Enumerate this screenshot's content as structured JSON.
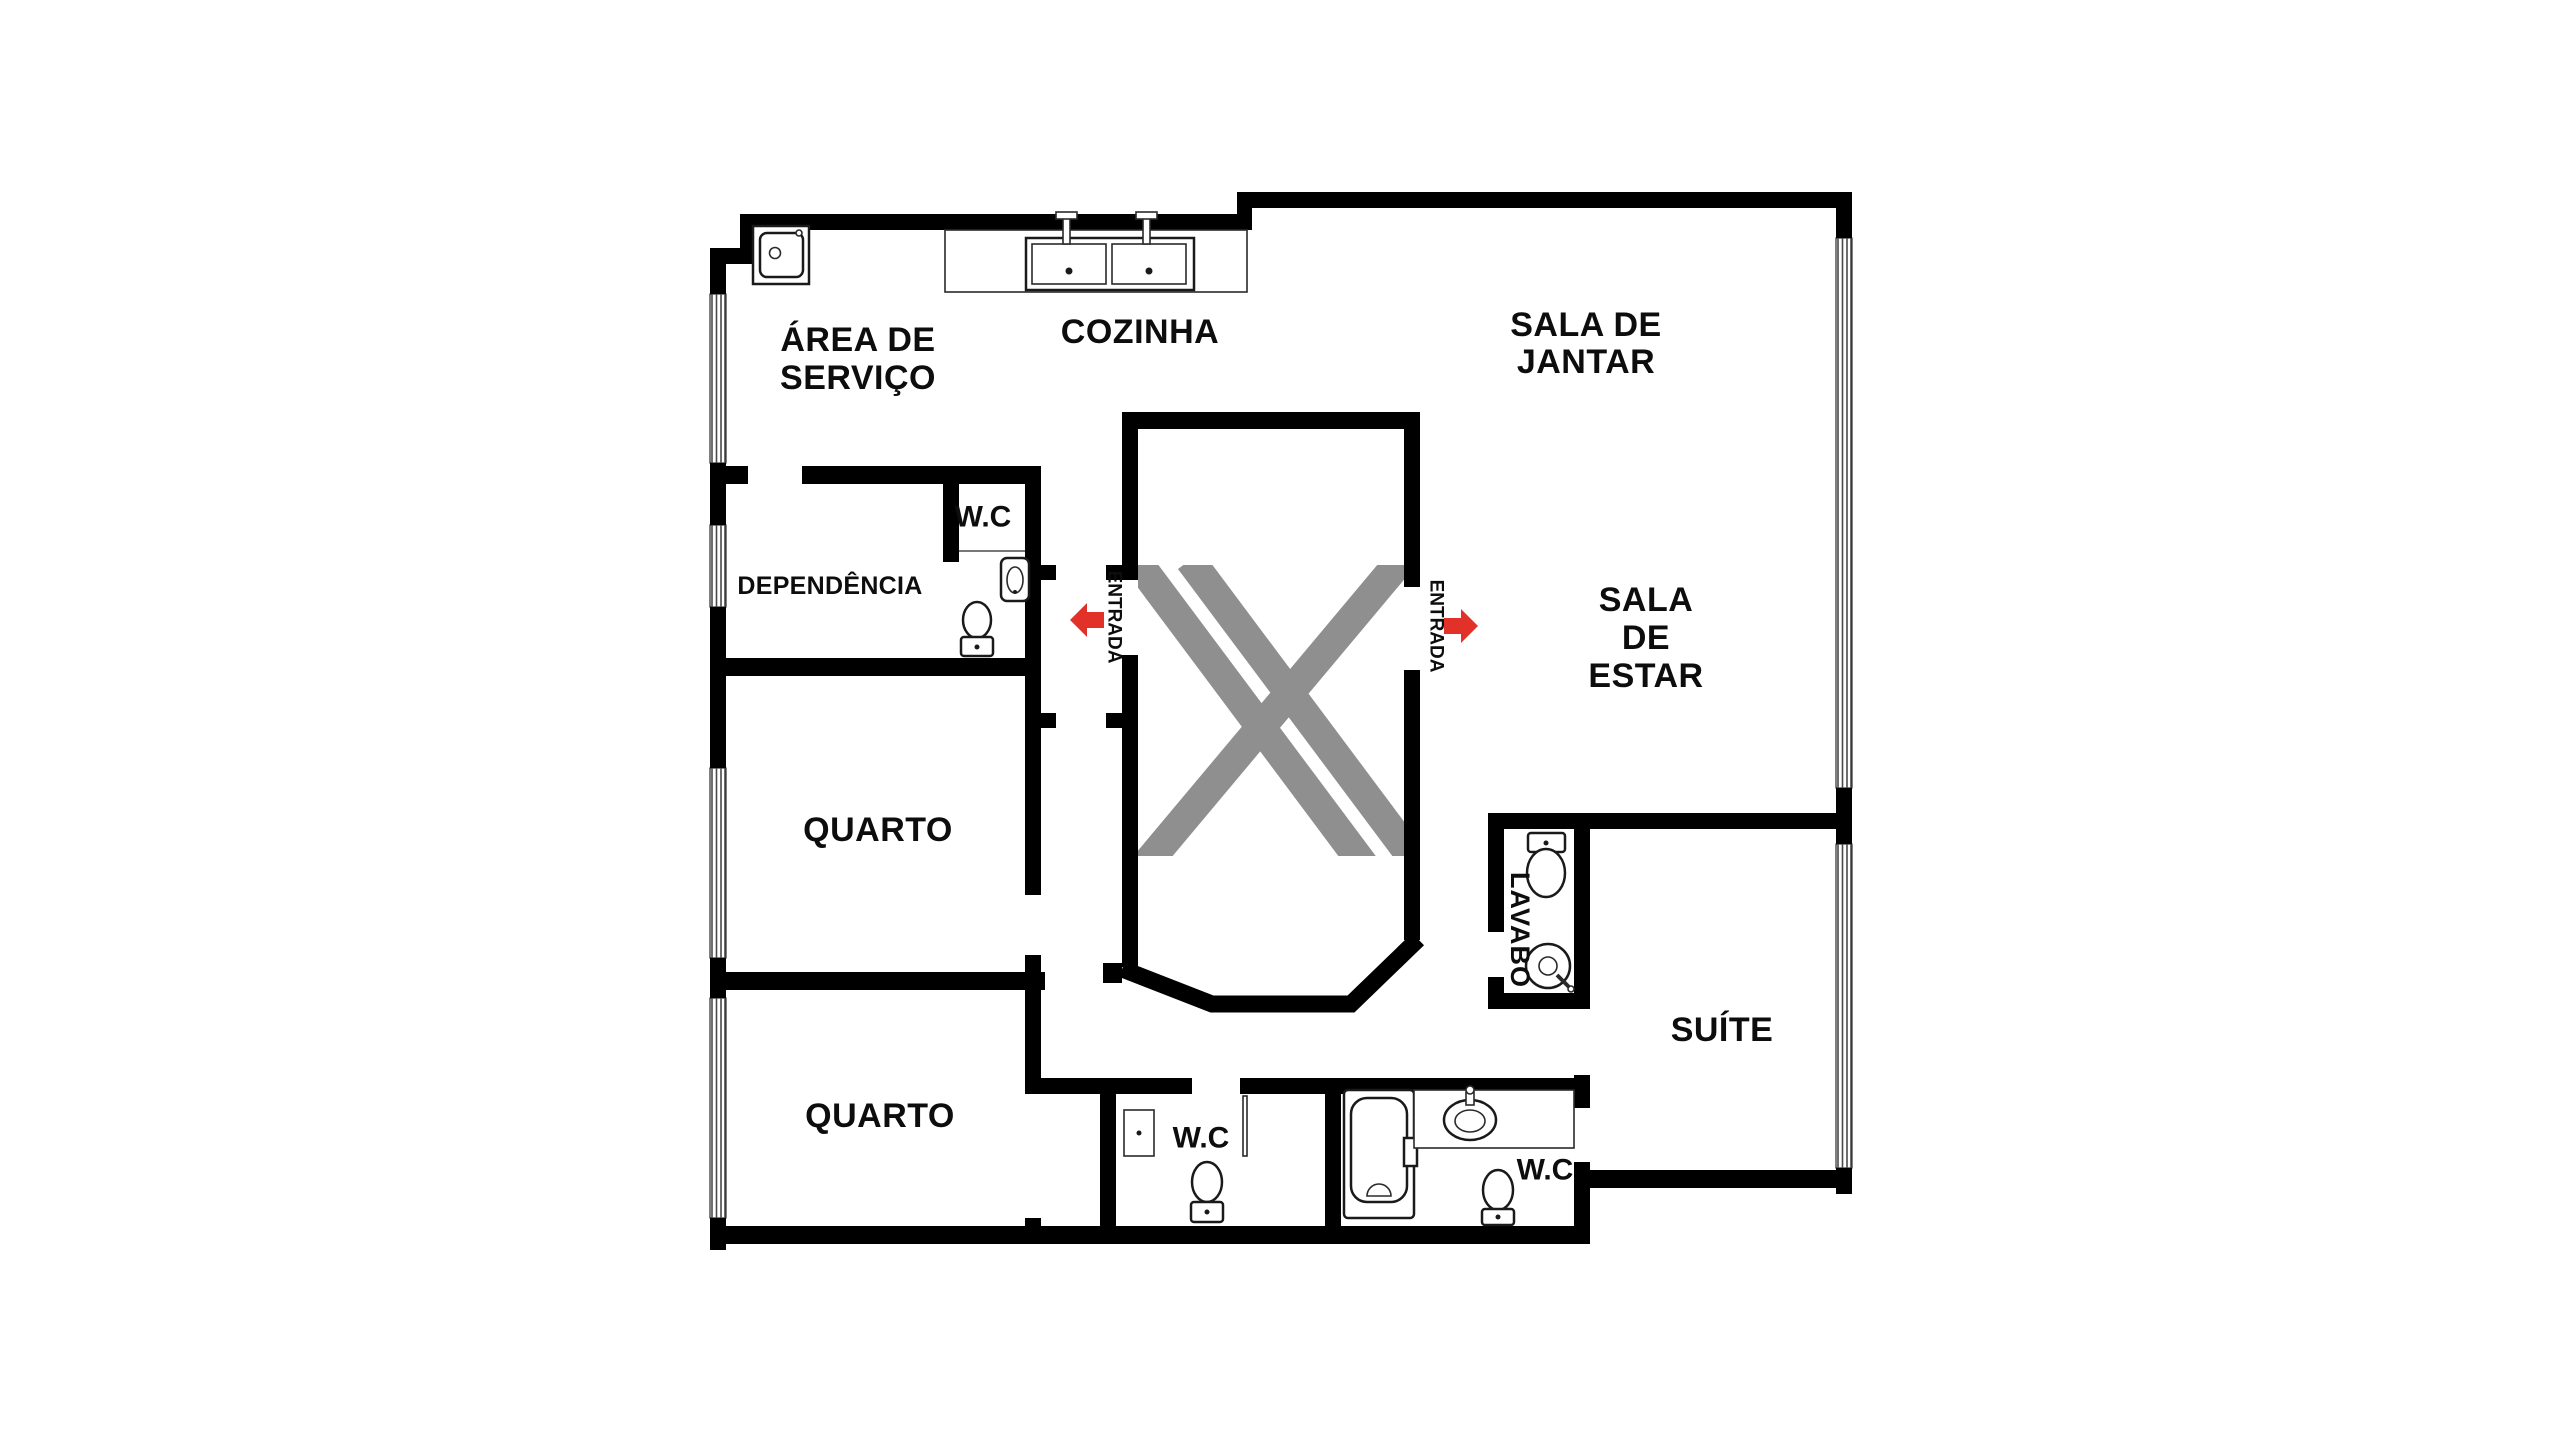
{
  "page": {
    "type": "apartment-floor-plan",
    "language": "pt-BR",
    "background": "#ffffff"
  },
  "colors": {
    "wall": "#000000",
    "stripe": "#8f8f8f",
    "arrow": "#e23128",
    "text": "#0d0d0d"
  },
  "labels": {
    "area_servico_1": "ÁREA DE",
    "area_servico_2": "SERVIÇO",
    "cozinha": "COZINHA",
    "sala_jantar_1": "SALA DE",
    "sala_jantar_2": "JANTAR",
    "sala_estar_1": "SALA",
    "sala_estar_2": "DE",
    "sala_estar_3": "ESTAR",
    "dependencia": "DEPENDÊNCIA",
    "wc_dependencia": "W.C",
    "quarto_meio": "QUARTO",
    "quarto_inferior": "QUARTO",
    "wc_social": "W.C",
    "wc_suite": "W.C",
    "suite": "SUÍTE",
    "lavabo": "LAVABO",
    "entrada_esquerda": "ENTRADA",
    "entrada_direita": "ENTRADA"
  },
  "rooms": [
    {
      "name": "area-de-servico",
      "label": "ÁREA DE SERVIÇO"
    },
    {
      "name": "cozinha",
      "label": "COZINHA"
    },
    {
      "name": "sala-de-jantar",
      "label": "SALA DE JANTAR"
    },
    {
      "name": "sala-de-estar",
      "label": "SALA DE ESTAR"
    },
    {
      "name": "dependencia",
      "label": "DEPENDÊNCIA"
    },
    {
      "name": "wc-dependencia",
      "label": "W.C"
    },
    {
      "name": "quarto-1",
      "label": "QUARTO"
    },
    {
      "name": "quarto-2",
      "label": "QUARTO"
    },
    {
      "name": "wc-social",
      "label": "W.C"
    },
    {
      "name": "wc-suite",
      "label": "W.C"
    },
    {
      "name": "lavabo",
      "label": "LAVABO"
    },
    {
      "name": "suite",
      "label": "SUÍTE"
    }
  ],
  "entrances": [
    {
      "label": "ENTRADA",
      "direction": "left"
    },
    {
      "label": "ENTRADA",
      "direction": "right"
    }
  ],
  "fixtures": [
    "laundry-sink",
    "kitchen-double-sink",
    "kitchen-counter",
    "wall-sink",
    "toilet-dependencia",
    "shower-stall",
    "toilet-social",
    "bathtub",
    "vanity-sink",
    "toilet-suite",
    "toilet-lavabo",
    "round-washbasin"
  ],
  "windows_count": 6
}
